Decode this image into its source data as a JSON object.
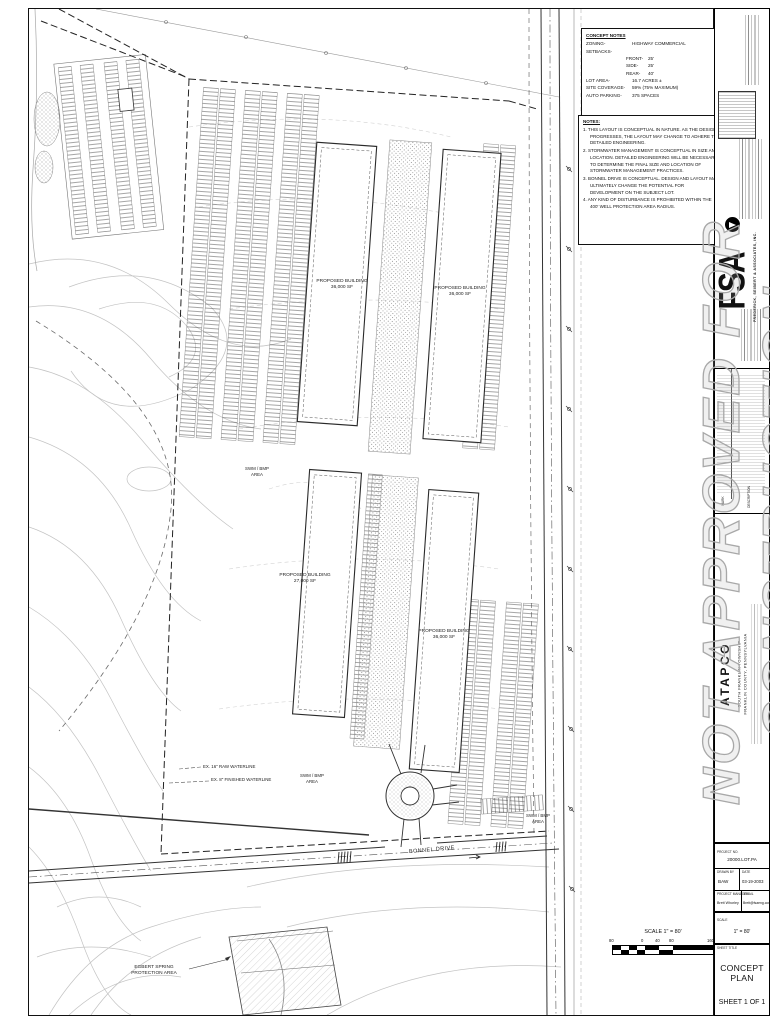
{
  "sheet": {
    "watermark": "NOT APPROVED FOR CONSTRUCTION",
    "sheet_number": "SHEET  1  OF  1"
  },
  "concept_notes": {
    "title": "CONCEPT NOTES",
    "zoning_label": "ZONING-",
    "zoning_value": "HIGHWAY COMMERCIAL",
    "setbacks_label": "SETBACKS-",
    "front_label": "FRONT-",
    "front_value": "25'",
    "side_label": "SIDE-",
    "side_value": "25'",
    "rear_label": "REAR-",
    "rear_value": "40'",
    "lot_area_label": "LOT AREA-",
    "lot_area_value": "16.7 ACRES ±",
    "site_coverage_label": "SITE COVERAGE-",
    "site_coverage_value": "59% (75% MAXIMUM)",
    "auto_parking_label": "AUTO PARKING-",
    "auto_parking_value": "375 SPACES"
  },
  "notes": {
    "title": "NOTES:",
    "items": [
      "1. THIS LAYOUT IS CONCEPTUAL IN NATURE.  AS THE DESIGN PROGRESSES, THE LAYOUT MAY CHANGE TO ADHERE TO DETAILED ENGINEERING.",
      "2. STORMWATER MANAGEMENT IS CONCEPTUAL IN SIZE AND LOCATION.  DETAILED ENGINEERING WILL BE NECESSARY TO DETERMINE THE FINAL SIZE AND LOCATION OF STORMWATER MANAGEMENT PRACTICES.",
      "3. BONNEL DRIVE IS CONCEPTUAL.  DESIGN AND LAYOUT MAY ULTIMATELY CHANGE THE POTENTIAL FOR DEVELOPMENT ON THE SUBJECT LOT.",
      "4. ANY KIND OF DISTURBANCE IS PROHIBITED WITHIN THE 400' WELL PROTECTION AREA RADIUS."
    ]
  },
  "plan": {
    "buildings": [
      {
        "label": "PROPOSED BUILDING",
        "area": "36,000 SF"
      },
      {
        "label": "PROPOSED BUILDING",
        "area": "36,000 SF"
      },
      {
        "label": "PROPOSED BUILDING",
        "area": "27,000 SF"
      },
      {
        "label": "PROPOSED BUILDING",
        "area": "36,000 SF"
      }
    ],
    "swm_line1": "SWM / BMP",
    "swm_line2": "AREA",
    "waterline1": "EX. 16\" RAW WATERLINE",
    "waterline2": "EX. 8\" FINISHED WATERLINE",
    "road_label": "BONNEL DRIVE",
    "spring_line1": "EGBERT SPRING",
    "spring_line2": "PROTECTION AREA",
    "scale_text": "SCALE  1\" = 80'",
    "scale_ticks": [
      "80",
      "0",
      "40",
      "80",
      "160"
    ]
  },
  "titleblock": {
    "firm": "FSA",
    "firm_name": "FREDERICK, SEIBERT & ASSOCIATES, INC.",
    "revisions_mark": "MARK",
    "revisions_description": "DESCRIPTION",
    "client": "ATAPCO",
    "location_line1": "SOUTH FRANKLIN TOWNSHIP",
    "location_line2": "FRANKLIN COUNTY, PENNSYLVANIA",
    "project_no_label": "PROJECT NO.",
    "project_no": "20000.LOT.PA",
    "drawn_by_label": "DRAWN BY",
    "drawn_by": "BAW",
    "date_label": "DATE",
    "date": "03-19-2003",
    "pm_label": "PROJECT MANAGER",
    "pm": "Brett Whorley",
    "email_label": "EMAIL",
    "email": "Brett@fsaeng.com",
    "scale_label": "SCALE",
    "scale": "1\" = 80'",
    "sheet_title_label": "SHEET TITLE",
    "sheet_title": "CONCEPT PLAN"
  }
}
